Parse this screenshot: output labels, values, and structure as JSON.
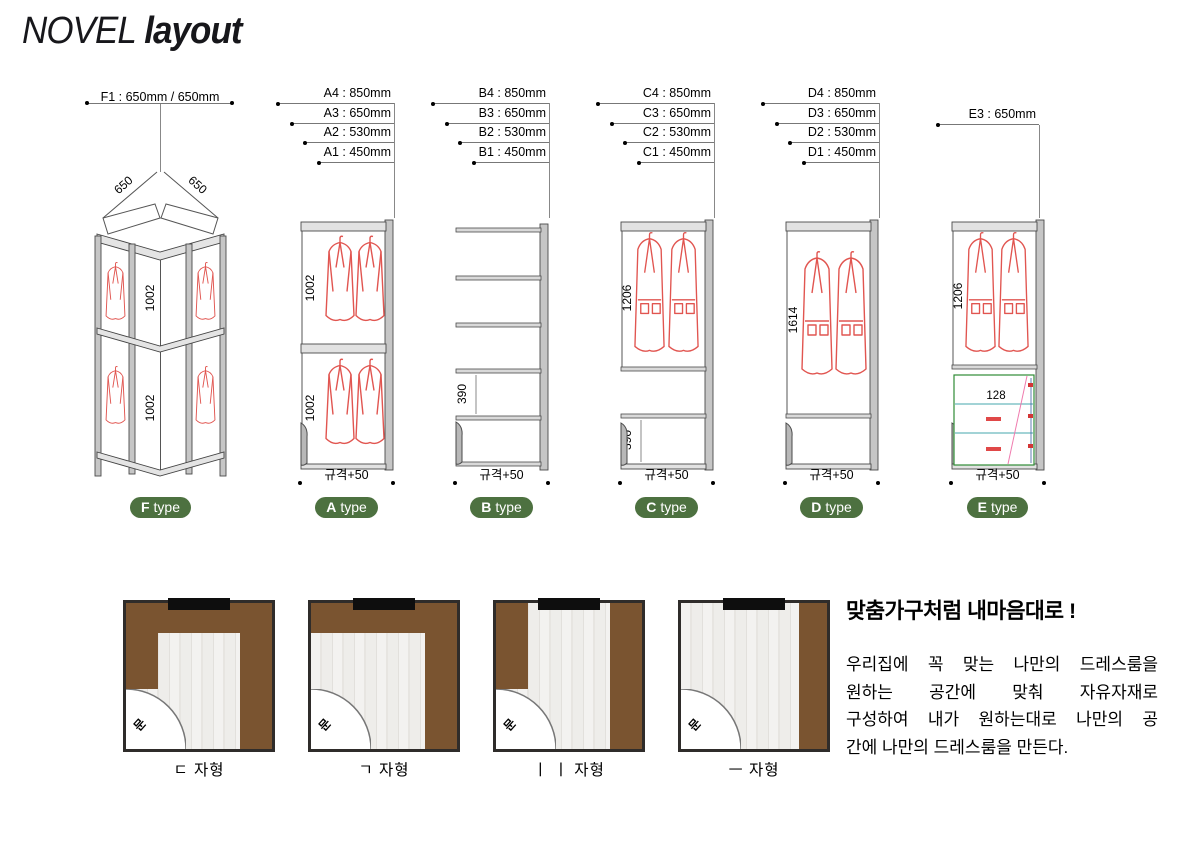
{
  "header": {
    "brand": "NOVEL",
    "word": "layout"
  },
  "units": {
    "f": {
      "dim": "F1 : 650mm / 650mm",
      "left650": "650",
      "right650": "650",
      "sec1": "1002",
      "sec2": "1002",
      "badge_letter": "F",
      "badge_word": "type"
    },
    "a": {
      "dims": [
        "A4 : 850mm",
        "A3 : 650mm",
        "A2 : 530mm",
        "A1 : 450mm"
      ],
      "sec1": "1002",
      "sec2": "1002",
      "width_label": "규격+50",
      "badge_letter": "A",
      "badge_word": "type"
    },
    "b": {
      "dims": [
        "B4 : 850mm",
        "B3 : 650mm",
        "B2 : 530mm",
        "B1 : 450mm"
      ],
      "shelf_dim": "390",
      "width_label": "규격+50",
      "badge_letter": "B",
      "badge_word": "type"
    },
    "c": {
      "dims": [
        "C4 : 850mm",
        "C3 : 650mm",
        "C2 : 530mm",
        "C1 : 450mm"
      ],
      "hang_dim": "1206",
      "shelf_dim": "390",
      "width_label": "규격+50",
      "badge_letter": "C",
      "badge_word": "type"
    },
    "d": {
      "dims": [
        "D4 : 850mm",
        "D3 : 650mm",
        "D2 : 530mm",
        "D1 : 450mm"
      ],
      "hang_dim": "1614",
      "width_label": "규격+50",
      "badge_letter": "D",
      "badge_word": "type"
    },
    "e": {
      "dim": "E3 : 650mm",
      "hang_dim": "1206",
      "drawer_dim": "128",
      "width_label": "규격+50",
      "badge_letter": "E",
      "badge_word": "type"
    }
  },
  "rooms": [
    {
      "label": "ㄷ 자형",
      "door": "문"
    },
    {
      "label": "ㄱ 자형",
      "door": "문"
    },
    {
      "label": "ㅣ ㅣ 자형",
      "door": "문"
    },
    {
      "label": "ㅡ 자형",
      "door": "문"
    }
  ],
  "description": {
    "title": "맞춤가구처럼 내마음대로 !",
    "lines": [
      "우리집에 꼭 맞는 나만의 드레스룸을",
      "원하는 공간에 맞춰 자유자재로",
      "구성하여 내가 원하는대로 나만의 공",
      "간에 나만의 드레스룸을 만든다."
    ]
  },
  "colors": {
    "badge_green": "#4d7140",
    "furniture_brown": "#7a5430",
    "sketch_red": "#e15550"
  }
}
